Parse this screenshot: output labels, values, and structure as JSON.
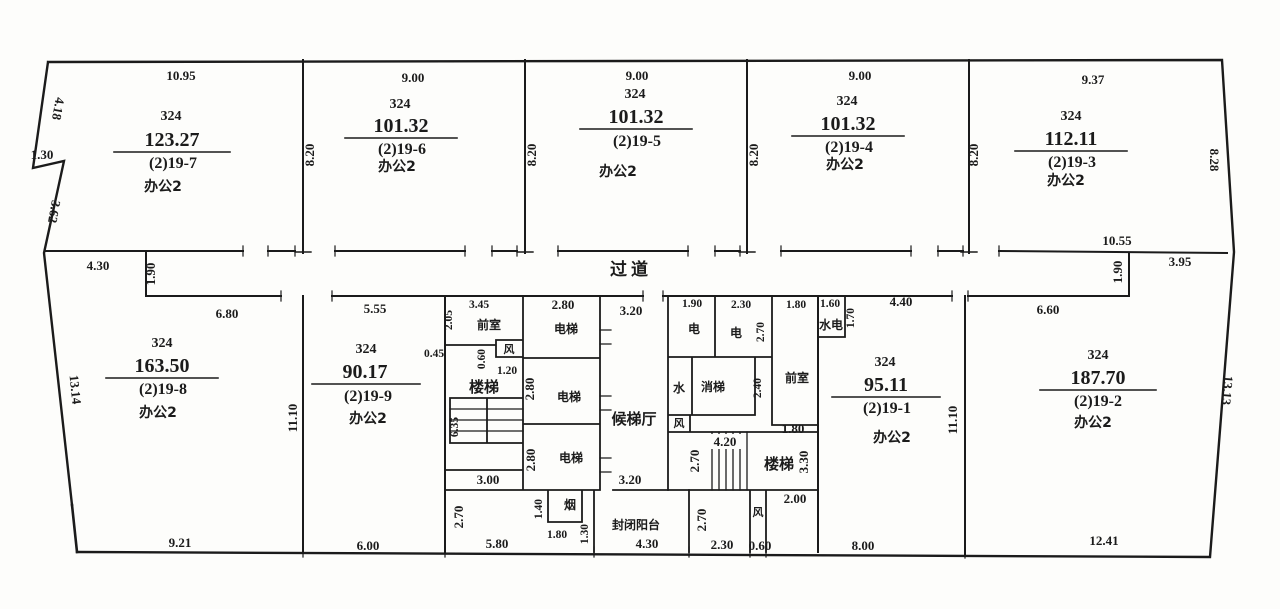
{
  "units": [
    {
      "no": "324",
      "area": "123.27",
      "parcel": "(2)19-7",
      "use": "办公2"
    },
    {
      "no": "324",
      "area": "101.32",
      "parcel": "(2)19-6",
      "use": "办公2"
    },
    {
      "no": "324",
      "area": "101.32",
      "parcel": "(2)19-5",
      "use": "办公2"
    },
    {
      "no": "324",
      "area": "101.32",
      "parcel": "(2)19-4",
      "use": "办公2"
    },
    {
      "no": "324",
      "area": "112.11",
      "parcel": "(2)19-3",
      "use": "办公2"
    },
    {
      "no": "324",
      "area": "163.50",
      "parcel": "(2)19-8",
      "use": "办公2"
    },
    {
      "no": "324",
      "area": "90.17",
      "parcel": "(2)19-9",
      "use": "办公2"
    },
    {
      "no": "324",
      "area": "95.11",
      "parcel": "(2)19-1",
      "use": "办公2"
    },
    {
      "no": "324",
      "area": "187.70",
      "parcel": "(2)19-2",
      "use": "办公2"
    }
  ],
  "labels": {
    "passage": "过道",
    "front_room": "前室",
    "stairs": "楼梯",
    "elevator": "电梯",
    "lobby": "候梯厅",
    "water": "水",
    "electric": "电",
    "fire_elevator": "消梯",
    "water_electric": "水电",
    "vent": "风",
    "smoke": "烟",
    "balcony": "封闭阳台"
  },
  "dims": {
    "u7_top": "10.95",
    "u6_top": "9.00",
    "u5_top": "9.00",
    "u4_top": "9.00",
    "u3_top": "9.37",
    "w1": "8.20",
    "w2": "8.20",
    "w3": "8.20",
    "w4": "8.20",
    "right_upper": "8.28",
    "left_a": "4.18",
    "left_b": "1.30",
    "left_c": "3.62",
    "left_lower": "13.14",
    "u3_bottom": "10.55",
    "step_right": "1.90",
    "notch_right": "3.95",
    "corridor_left": "4.30",
    "step_left": "1.90",
    "u8_top": "6.80",
    "u8_bottom": "9.21",
    "u9_bottom": "6.00",
    "u9_top": "5.55",
    "u9_left": "11.10",
    "u1_left": "11.10",
    "gap": "0.45",
    "front_w": "3.45",
    "front_h": "2.05",
    "vent_h": "0.60",
    "vent_w": "1.20",
    "stair_h": "6.35",
    "stair_w": "3.00",
    "elev_w": "2.80",
    "elev2_h": "2.80",
    "elev3_h": "2.80",
    "lobby_top": "3.20",
    "lobby_bottom": "3.20",
    "under_h": "2.70",
    "under_w": "5.80",
    "smoke_h": "1.40",
    "smoke_w": "1.80",
    "balcony_h": "1.30",
    "balcony_w": "4.30",
    "elec1_w": "1.90",
    "elec2_w": "2.30",
    "elec2_h": "2.70",
    "front2_w": "1.80",
    "front2_b": "1.80",
    "fire_h": "2.40",
    "we_w": "1.60",
    "we_h": "1.70",
    "corridor_r1": "4.40",
    "corridor_r2": "6.60",
    "stair2_l": "2.70",
    "stair2_w": "4.20",
    "stair2_r": "3.30",
    "landing_w": "2.00",
    "lower_h": "2.70",
    "bottom_a": "2.30",
    "bottom_b": "0.60",
    "bottom_c": "8.00",
    "u2_bottom": "12.41",
    "right_lower": "13.13"
  },
  "colors": {
    "line": "#1b1b1b",
    "red_segment": "#b03a2e"
  }
}
